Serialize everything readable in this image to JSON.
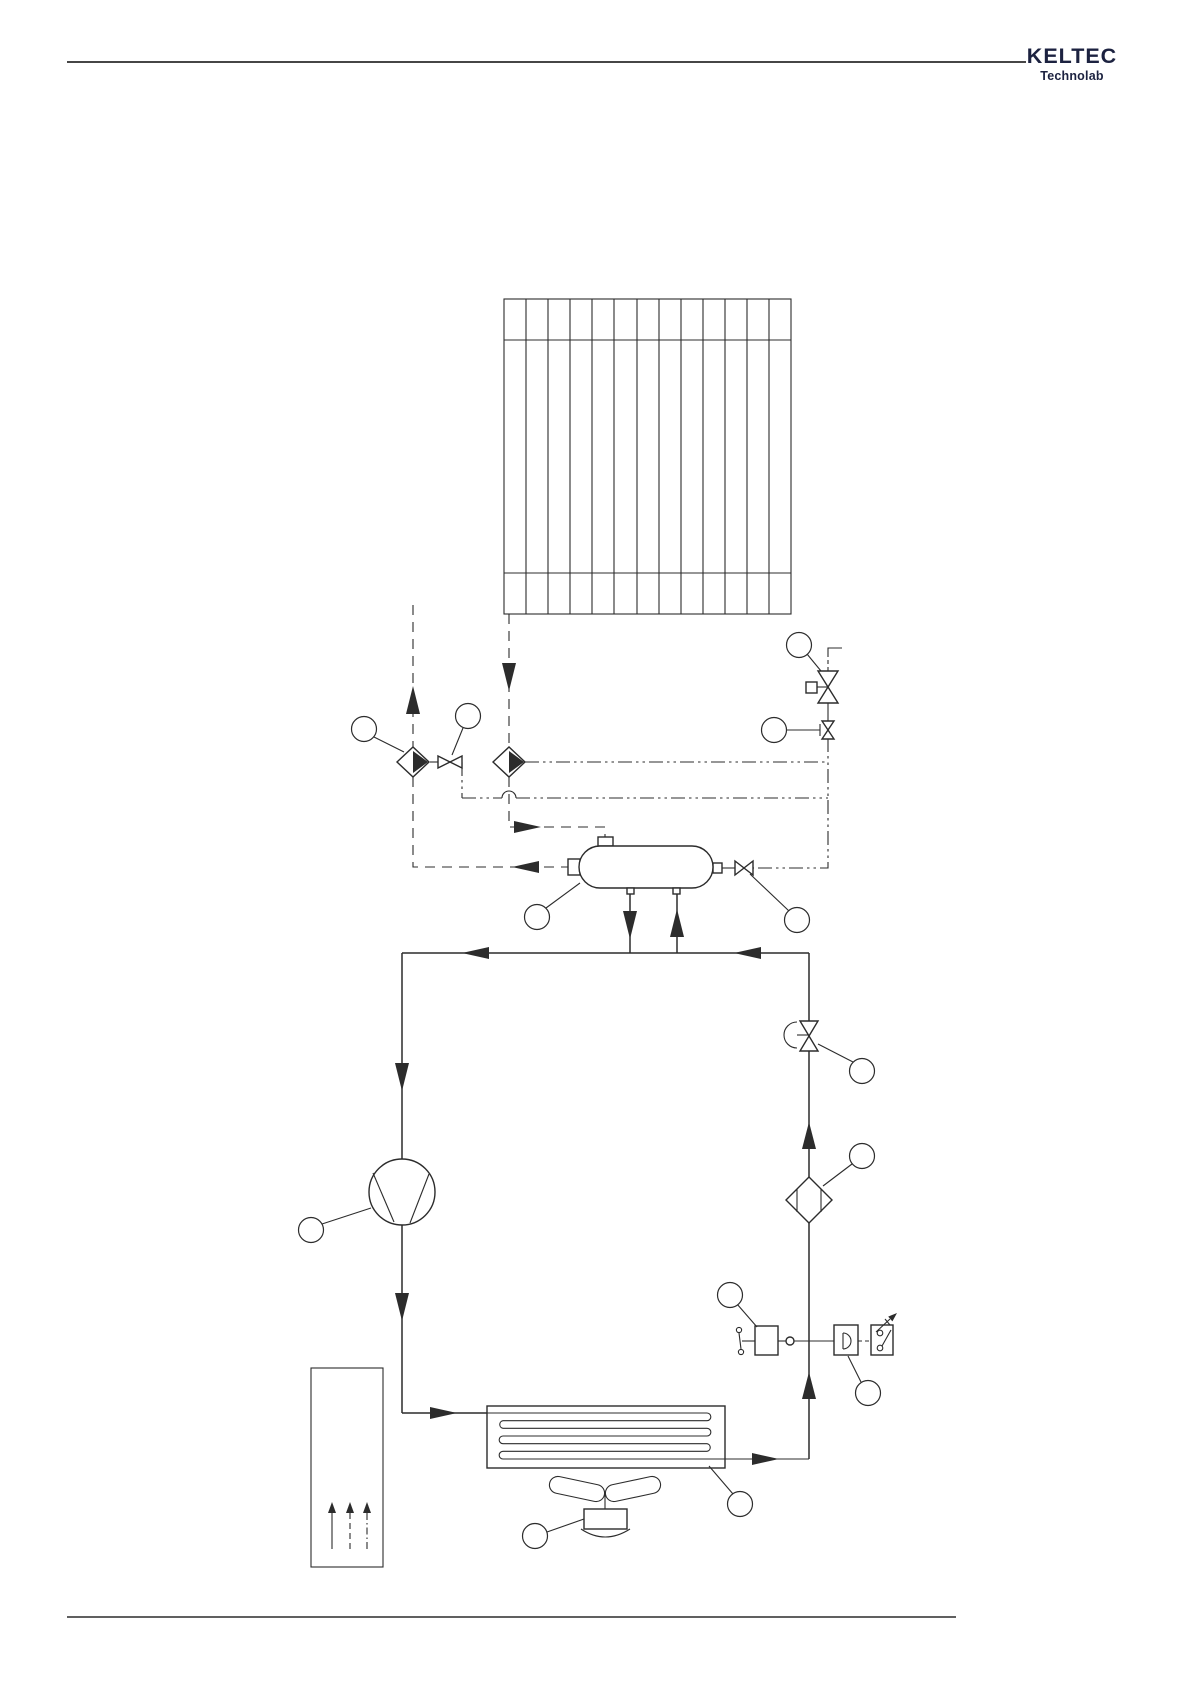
{
  "page": {
    "width": 1191,
    "height": 1684
  },
  "theme": {
    "paper": "#ffffff",
    "ink": "#2c2c2c",
    "logo": "#1c2240"
  },
  "header": {
    "brand": "KELTEC",
    "brand_sub": "Technolab"
  },
  "diagram": {
    "type": "pneumatic-schematic",
    "callout_balloons": {
      "count": 13,
      "label": ""
    },
    "components": [
      "aftercooler-radiator",
      "purge-exhaust-filter",
      "purge-needle-valve",
      "regeneration-air-filter",
      "solenoid-vent-valve",
      "pilot-valve",
      "water-separator",
      "separator-drain-valve",
      "shutoff-valve",
      "line-filter",
      "compressor",
      "pressure-regulator",
      "pressure-switch",
      "cooling-coil",
      "cooling-fan",
      "fan-motor",
      "air-duct"
    ],
    "flow_line_styles": [
      "solid",
      "dashed",
      "dash-dot-dot"
    ]
  }
}
